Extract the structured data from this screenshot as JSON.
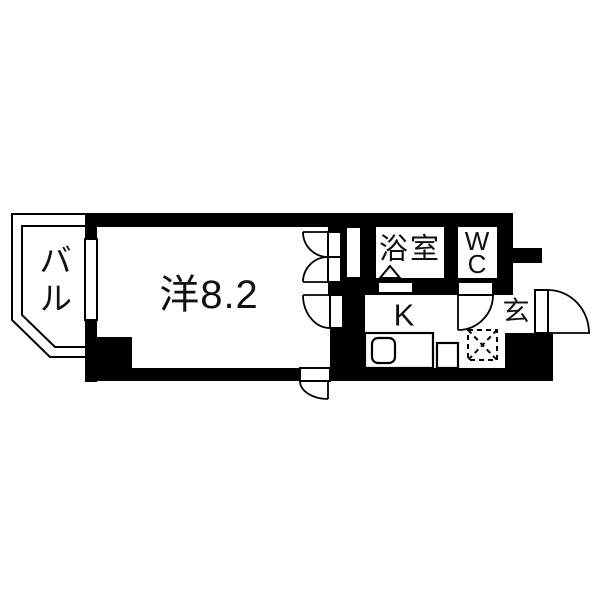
{
  "title": "apartment floor plan",
  "rooms": {
    "balcony": {
      "label": "バル"
    },
    "western_room": {
      "label": "洋8.2"
    },
    "bathroom": {
      "label": "浴室"
    },
    "toilet": {
      "label": "WC"
    },
    "kitchen": {
      "label": "K"
    },
    "entrance": {
      "label": "玄"
    }
  },
  "colors": {
    "wall": "#000000",
    "line": "#000000",
    "floor": "#ffffff"
  }
}
